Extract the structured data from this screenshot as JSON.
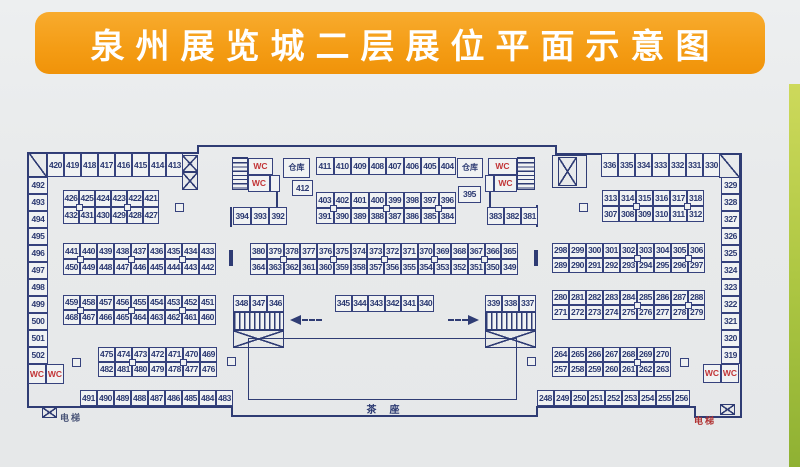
{
  "title": "泉州展览城二层展位平面示意图",
  "colors": {
    "banner_orange": "#f49c14",
    "plan_line_navy": "#2f3c74",
    "wc_red": "#c23537",
    "page_bg": "#e8eaeb",
    "right_edge_green": "#aec743"
  },
  "plan": {
    "labels": {
      "tea": "茶座",
      "elevator": "电梯",
      "warehouse": "仓库",
      "wc": "WC"
    },
    "groups": [
      {
        "id": "row-420",
        "x": 47,
        "y": 153,
        "cw": 17,
        "ch": 24,
        "rows": [
          [
            "420",
            "419",
            "418",
            "417",
            "416",
            "415",
            "414",
            "413"
          ]
        ]
      },
      {
        "id": "col-492",
        "x": 28,
        "y": 177,
        "cw": 20,
        "ch": 17,
        "rows": [
          [
            "492"
          ],
          [
            "493"
          ],
          [
            "494"
          ],
          [
            "495"
          ],
          [
            "496"
          ],
          [
            "497"
          ],
          [
            "498"
          ],
          [
            "499"
          ],
          [
            "500"
          ],
          [
            "501"
          ],
          [
            "502"
          ]
        ]
      },
      {
        "id": "wc-left",
        "x": 28,
        "y": 364,
        "cw": 18,
        "ch": 20,
        "red": true,
        "rows": [
          [
            "WC",
            "WC"
          ]
        ]
      },
      {
        "id": "blk-426",
        "x": 63,
        "y": 190,
        "cw": 16,
        "ch": 17,
        "joints": [
          1,
          4
        ],
        "rows": [
          [
            "426",
            "425",
            "424",
            "423",
            "422",
            "421"
          ],
          [
            "432",
            "431",
            "430",
            "429",
            "428",
            "427"
          ]
        ]
      },
      {
        "id": "blk-441",
        "x": 63,
        "y": 243,
        "cw": 17,
        "ch": 16,
        "joints": [
          1,
          4,
          7
        ],
        "rows": [
          [
            "441",
            "440",
            "439",
            "438",
            "437",
            "436",
            "435",
            "434",
            "433"
          ],
          [
            "450",
            "449",
            "448",
            "447",
            "446",
            "445",
            "444",
            "443",
            "442"
          ]
        ]
      },
      {
        "id": "blk-459",
        "x": 63,
        "y": 295,
        "cw": 17,
        "ch": 15,
        "joints": [
          1,
          4,
          7
        ],
        "rows": [
          [
            "459",
            "458",
            "457",
            "456",
            "455",
            "454",
            "453",
            "452",
            "451"
          ],
          [
            "468",
            "467",
            "466",
            "465",
            "464",
            "463",
            "462",
            "461",
            "460"
          ]
        ]
      },
      {
        "id": "blk-475",
        "x": 98,
        "y": 347,
        "cw": 17,
        "ch": 15,
        "joints": [
          2,
          5
        ],
        "rows": [
          [
            "475",
            "474",
            "473",
            "472",
            "471",
            "470",
            "469"
          ],
          [
            "482",
            "481",
            "480",
            "479",
            "478",
            "477",
            "476"
          ]
        ]
      },
      {
        "id": "row-491",
        "x": 80,
        "y": 390,
        "cw": 17,
        "ch": 16,
        "rows": [
          [
            "491",
            "490",
            "489",
            "488",
            "487",
            "486",
            "485",
            "484",
            "483"
          ]
        ]
      },
      {
        "id": "wc-ctr-l1",
        "x": 248,
        "y": 158,
        "cw": 25,
        "ch": 17,
        "red": true,
        "rows": [
          [
            "WC"
          ]
        ]
      },
      {
        "id": "wc-ctr-l2",
        "x": 248,
        "y": 175,
        "cw": 22,
        "ch": 17,
        "red": true,
        "rows": [
          [
            "WC"
          ]
        ]
      },
      {
        "id": "door-l",
        "x": 270,
        "y": 175,
        "cw": 10,
        "ch": 17,
        "rows": [
          [
            ""
          ]
        ]
      },
      {
        "id": "wh-left",
        "x": 283,
        "y": 158,
        "cw": 27,
        "ch": 20,
        "cls": "wh",
        "rows": [
          [
            "仓库"
          ]
        ]
      },
      {
        "id": "cell-412",
        "x": 292,
        "y": 180,
        "cw": 21,
        "ch": 16,
        "rows": [
          [
            "412"
          ]
        ]
      },
      {
        "id": "row-394",
        "x": 233,
        "y": 207,
        "cw": 18,
        "ch": 18,
        "rows": [
          [
            "394",
            "393",
            "392"
          ]
        ]
      },
      {
        "id": "row-411",
        "x": 316,
        "y": 157,
        "cw": 17.5,
        "ch": 18,
        "rows": [
          [
            "411",
            "410",
            "409",
            "408",
            "407",
            "406",
            "405",
            "404"
          ]
        ]
      },
      {
        "id": "blk-403",
        "x": 316,
        "y": 192,
        "cw": 17.5,
        "ch": 16,
        "joints": [
          1,
          4,
          7
        ],
        "rows": [
          [
            "403",
            "402",
            "401",
            "400",
            "399",
            "398",
            "397",
            "396"
          ],
          [
            "391",
            "390",
            "389",
            "388",
            "387",
            "386",
            "385",
            "384"
          ]
        ]
      },
      {
        "id": "wh-right",
        "x": 457,
        "y": 158,
        "cw": 26,
        "ch": 20,
        "cls": "wh",
        "rows": [
          [
            "仓库"
          ]
        ]
      },
      {
        "id": "cell-395",
        "x": 458,
        "y": 186,
        "cw": 23,
        "ch": 17,
        "rows": [
          [
            "395"
          ]
        ]
      },
      {
        "id": "door-r",
        "x": 485,
        "y": 175,
        "cw": 9,
        "ch": 17,
        "rows": [
          [
            ""
          ]
        ]
      },
      {
        "id": "wc-ctr-r1",
        "x": 488,
        "y": 158,
        "cw": 29,
        "ch": 17,
        "red": true,
        "rows": [
          [
            "WC"
          ]
        ]
      },
      {
        "id": "wc-ctr-r2",
        "x": 494,
        "y": 175,
        "cw": 23,
        "ch": 17,
        "red": true,
        "rows": [
          [
            "WC"
          ]
        ]
      },
      {
        "id": "row-383",
        "x": 487,
        "y": 207,
        "cw": 17,
        "ch": 18,
        "rows": [
          [
            "383",
            "382",
            "381"
          ]
        ]
      },
      {
        "id": "blk-380",
        "x": 250,
        "y": 243,
        "cw": 16.75,
        "ch": 16,
        "joints": [
          2,
          5,
          8,
          11,
          14
        ],
        "rows": [
          [
            "380",
            "379",
            "378",
            "377",
            "376",
            "375",
            "374",
            "373",
            "372",
            "371",
            "370",
            "369",
            "368",
            "367",
            "366",
            "365"
          ],
          [
            "364",
            "363",
            "362",
            "361",
            "360",
            "359",
            "358",
            "357",
            "356",
            "355",
            "354",
            "353",
            "352",
            "351",
            "350",
            "349"
          ]
        ]
      },
      {
        "id": "row-348",
        "x": 233,
        "y": 295,
        "cw": 17,
        "ch": 17,
        "rows": [
          [
            "348",
            "347",
            "346"
          ]
        ]
      },
      {
        "id": "row-345",
        "x": 335,
        "y": 295,
        "cw": 16.5,
        "ch": 17,
        "rows": [
          [
            "345",
            "344",
            "343",
            "342",
            "341",
            "340"
          ]
        ]
      },
      {
        "id": "row-339",
        "x": 485,
        "y": 295,
        "cw": 17,
        "ch": 17,
        "rows": [
          [
            "339",
            "338",
            "337"
          ]
        ]
      },
      {
        "id": "row-336",
        "x": 601,
        "y": 153,
        "cw": 17,
        "ch": 24,
        "rows": [
          [
            "336",
            "335",
            "334",
            "333",
            "332",
            "331",
            "330"
          ]
        ]
      },
      {
        "id": "col-329",
        "x": 721,
        "y": 177,
        "cw": 19,
        "ch": 17,
        "rows": [
          [
            "329"
          ],
          [
            "328"
          ],
          [
            "327"
          ],
          [
            "326"
          ],
          [
            "325"
          ],
          [
            "324"
          ],
          [
            "323"
          ],
          [
            "322"
          ],
          [
            "321"
          ],
          [
            "320"
          ],
          [
            "319"
          ]
        ]
      },
      {
        "id": "wc-right",
        "x": 703,
        "y": 364,
        "cw": 18,
        "ch": 19,
        "red": true,
        "rows": [
          [
            "WC",
            "WC"
          ]
        ]
      },
      {
        "id": "blk-313",
        "x": 602,
        "y": 190,
        "cw": 17,
        "ch": 16,
        "joints": [
          2,
          5
        ],
        "rows": [
          [
            "313",
            "314",
            "315",
            "316",
            "317",
            "318"
          ],
          [
            "307",
            "308",
            "309",
            "310",
            "311",
            "312"
          ]
        ]
      },
      {
        "id": "blk-298",
        "x": 552,
        "y": 243,
        "cw": 17,
        "ch": 15,
        "joints": [
          5,
          8
        ],
        "rows": [
          [
            "298",
            "299",
            "300",
            "301",
            "302",
            "303",
            "304",
            "305",
            "306"
          ],
          [
            "289",
            "290",
            "291",
            "292",
            "293",
            "294",
            "295",
            "296",
            "297"
          ]
        ]
      },
      {
        "id": "blk-280",
        "x": 552,
        "y": 290,
        "cw": 17,
        "ch": 15,
        "joints": [
          5,
          8
        ],
        "rows": [
          [
            "280",
            "281",
            "282",
            "283",
            "284",
            "285",
            "286",
            "287",
            "288"
          ],
          [
            "271",
            "272",
            "273",
            "274",
            "275",
            "276",
            "277",
            "278",
            "279"
          ]
        ]
      },
      {
        "id": "blk-264",
        "x": 552,
        "y": 347,
        "cw": 17,
        "ch": 15,
        "joints": [
          5
        ],
        "rows": [
          [
            "264",
            "265",
            "266",
            "267",
            "268",
            "269",
            "270"
          ],
          [
            "257",
            "258",
            "259",
            "260",
            "261",
            "262",
            "263"
          ]
        ]
      },
      {
        "id": "row-248",
        "x": 537,
        "y": 390,
        "cw": 17,
        "ch": 16,
        "rows": [
          [
            "248",
            "249",
            "250",
            "251",
            "252",
            "253",
            "254",
            "255",
            "256"
          ]
        ]
      }
    ],
    "pillars": [
      [
        175,
        203
      ],
      [
        579,
        203
      ],
      [
        72,
        358
      ],
      [
        680,
        358
      ],
      [
        227,
        357
      ],
      [
        527,
        357
      ]
    ]
  }
}
